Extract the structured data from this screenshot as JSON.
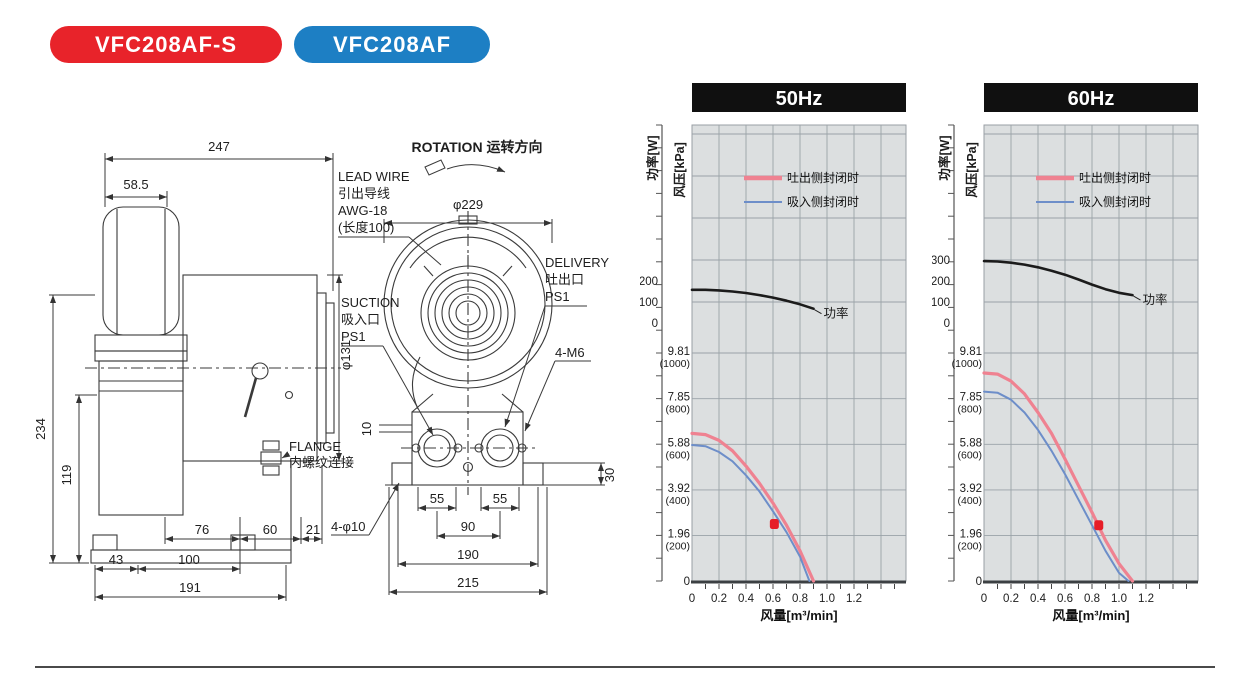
{
  "badges": [
    {
      "label": "VFC208AF-S",
      "color": "#e8232a"
    },
    {
      "label": "VFC208AF",
      "color": "#1d7fc4"
    }
  ],
  "drawing": {
    "side": {
      "dims": {
        "w247": "247",
        "w585": "58.5",
        "h234": "234",
        "h119": "119",
        "dia": "φ131",
        "d76": "76",
        "d60": "60",
        "d21": "21",
        "d43": "43",
        "d100": "100",
        "d191": "191"
      },
      "flange": [
        "FLANGE",
        "内螺纹连接"
      ]
    },
    "front": {
      "rotation": "ROTATION 运转方向",
      "dia": "φ229",
      "lead": [
        "LEAD WIRE",
        "引出导线",
        "AWG-18",
        "(长度100)"
      ],
      "suction": [
        "SUCTION",
        "吸入口",
        "PS1"
      ],
      "delivery": [
        "DELIVERY",
        "吐出口",
        "PS1"
      ],
      "m6": "4-M6",
      "phi10": "4-φ10",
      "dims": {
        "d10": "10",
        "d55a": "55",
        "d55b": "55",
        "d90": "90",
        "d190": "190",
        "d215": "215",
        "d30": "30"
      }
    }
  },
  "chart_data": [
    {
      "type": "line",
      "title": "50Hz",
      "xlabel": "风量[m³/min]",
      "power_axis_label": "功率[W]",
      "pressure_axis_label": "风压[kPa]",
      "xlim": [
        0,
        1.55
      ],
      "x_tick_labels": [
        "0",
        "0.2",
        "0.4",
        "0.6",
        "0.8",
        "1.0",
        "1.2"
      ],
      "pressure_ylim_kpa": [
        0,
        9.81
      ],
      "pressure_ticks": [
        {
          "kpa": "9.81",
          "mmaq": "(1000)"
        },
        {
          "kpa": "7.85",
          "mmaq": "(800)"
        },
        {
          "kpa": "5.88",
          "mmaq": "(600)"
        },
        {
          "kpa": "3.92",
          "mmaq": "(400)"
        },
        {
          "kpa": "1.96",
          "mmaq": "(200)"
        }
      ],
      "pressure_zero_label": "0",
      "power_ticks": [
        "200",
        "100",
        "0"
      ],
      "legend": [
        {
          "label": "吐出侧封闭时",
          "color": "#ef8291",
          "width": 4.5
        },
        {
          "label": "吸入侧封闭时",
          "color": "#6d8ec9",
          "width": 2
        }
      ],
      "power_label": "功率",
      "grid": true,
      "plot_bg": "#dcdfe0",
      "series": [
        {
          "name": "吐出侧封闭时",
          "axis": "pressure",
          "color": "#ef8291",
          "width": 3.2,
          "points": [
            [
              0,
              6.35
            ],
            [
              0.1,
              6.3
            ],
            [
              0.2,
              6.05
            ],
            [
              0.3,
              5.6
            ],
            [
              0.4,
              4.95
            ],
            [
              0.5,
              4.2
            ],
            [
              0.6,
              3.35
            ],
            [
              0.7,
              2.4
            ],
            [
              0.8,
              1.3
            ],
            [
              0.9,
              0
            ]
          ]
        },
        {
          "name": "吸入侧封闭时",
          "axis": "pressure",
          "color": "#6d8ec9",
          "width": 2,
          "points": [
            [
              0,
              5.85
            ],
            [
              0.1,
              5.8
            ],
            [
              0.2,
              5.55
            ],
            [
              0.3,
              5.15
            ],
            [
              0.4,
              4.55
            ],
            [
              0.5,
              3.85
            ],
            [
              0.6,
              3.0
            ],
            [
              0.7,
              2.1
            ],
            [
              0.8,
              1.05
            ],
            [
              0.87,
              0
            ]
          ]
        },
        {
          "name": "功率",
          "axis": "power",
          "color": "#1b1b1b",
          "width": 2.6,
          "points": [
            [
              0,
              158
            ],
            [
              0.1,
              158
            ],
            [
              0.2,
              155
            ],
            [
              0.3,
              150
            ],
            [
              0.4,
              143
            ],
            [
              0.5,
              133
            ],
            [
              0.6,
              121
            ],
            [
              0.7,
              106
            ],
            [
              0.8,
              89
            ],
            [
              0.9,
              68
            ]
          ]
        }
      ],
      "marker": {
        "x": 0.61,
        "kpa": 2.45,
        "color": "#e61e28"
      }
    },
    {
      "type": "line",
      "title": "60Hz",
      "xlabel": "风量[m³/min]",
      "power_axis_label": "功率[W]",
      "pressure_axis_label": "风压[kPa]",
      "xlim": [
        0,
        1.55
      ],
      "x_tick_labels": [
        "0",
        "0.2",
        "0.4",
        "0.6",
        "0.8",
        "1.0",
        "1.2"
      ],
      "pressure_ylim_kpa": [
        0,
        9.81
      ],
      "pressure_ticks": [
        {
          "kpa": "9.81",
          "mmaq": "(1000)"
        },
        {
          "kpa": "7.85",
          "mmaq": "(800)"
        },
        {
          "kpa": "5.88",
          "mmaq": "(600)"
        },
        {
          "kpa": "3.92",
          "mmaq": "(400)"
        },
        {
          "kpa": "1.96",
          "mmaq": "(200)"
        }
      ],
      "pressure_zero_label": "0",
      "power_ticks": [
        "300",
        "200",
        "100",
        "0"
      ],
      "legend": [
        {
          "label": "吐出侧封闭时",
          "color": "#ef8291",
          "width": 4.5
        },
        {
          "label": "吸入侧封闭时",
          "color": "#6d8ec9",
          "width": 2
        }
      ],
      "power_label": "功率",
      "grid": true,
      "plot_bg": "#dcdfe0",
      "series": [
        {
          "name": "吐出侧封闭时",
          "axis": "pressure",
          "color": "#ef8291",
          "width": 3.2,
          "points": [
            [
              0,
              8.95
            ],
            [
              0.1,
              8.9
            ],
            [
              0.2,
              8.6
            ],
            [
              0.3,
              8.05
            ],
            [
              0.4,
              7.25
            ],
            [
              0.5,
              6.35
            ],
            [
              0.6,
              5.25
            ],
            [
              0.7,
              4.1
            ],
            [
              0.8,
              2.95
            ],
            [
              0.9,
              1.75
            ],
            [
              1.0,
              0.75
            ],
            [
              1.1,
              0
            ]
          ]
        },
        {
          "name": "吸入侧封闭时",
          "axis": "pressure",
          "color": "#6d8ec9",
          "width": 2,
          "points": [
            [
              0,
              8.15
            ],
            [
              0.1,
              8.1
            ],
            [
              0.2,
              7.8
            ],
            [
              0.3,
              7.25
            ],
            [
              0.4,
              6.5
            ],
            [
              0.5,
              5.6
            ],
            [
              0.6,
              4.6
            ],
            [
              0.7,
              3.5
            ],
            [
              0.8,
              2.4
            ],
            [
              0.9,
              1.3
            ],
            [
              1.0,
              0.35
            ],
            [
              1.07,
              0
            ]
          ]
        },
        {
          "name": "功率",
          "axis": "power",
          "color": "#1b1b1b",
          "width": 2.6,
          "points": [
            [
              0,
              295
            ],
            [
              0.1,
              293
            ],
            [
              0.2,
              287
            ],
            [
              0.3,
              278
            ],
            [
              0.4,
              265
            ],
            [
              0.5,
              249
            ],
            [
              0.6,
              230
            ],
            [
              0.7,
              207
            ],
            [
              0.8,
              183
            ],
            [
              0.9,
              161
            ],
            [
              1.0,
              144
            ],
            [
              1.1,
              133
            ]
          ]
        }
      ],
      "marker": {
        "x": 0.85,
        "kpa": 2.4,
        "color": "#e61e28"
      }
    }
  ]
}
